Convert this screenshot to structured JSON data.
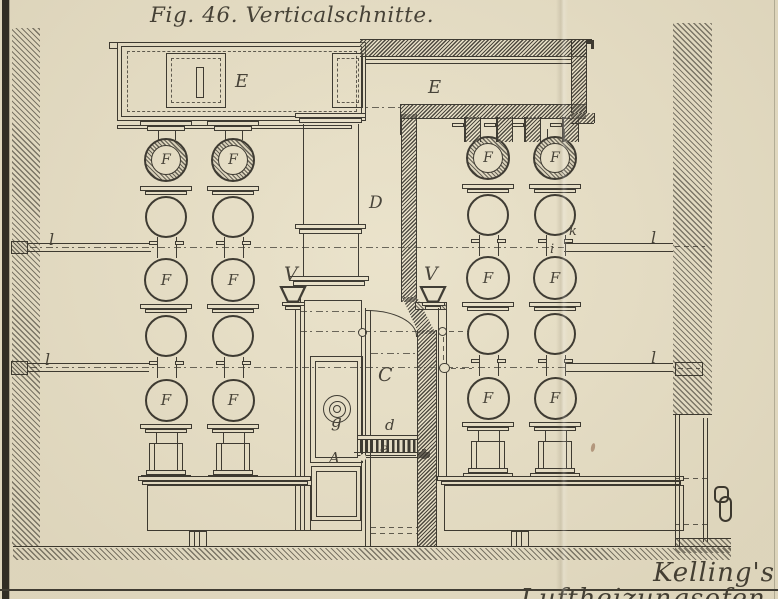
{
  "figure": {
    "title": "Fig. 46. Verticalschnitte.",
    "caption": "Kelling's Luftheizungsofen."
  },
  "labels": {
    "E": "E",
    "F": "F",
    "D": "D",
    "C": "C",
    "V": "V",
    "g": "g",
    "d": "d",
    "e": "e",
    "A": "A",
    "i": "i",
    "k": "k",
    "l": "l"
  },
  "colors": {
    "paper": "#e9e1c8",
    "ink": "#35322a"
  }
}
